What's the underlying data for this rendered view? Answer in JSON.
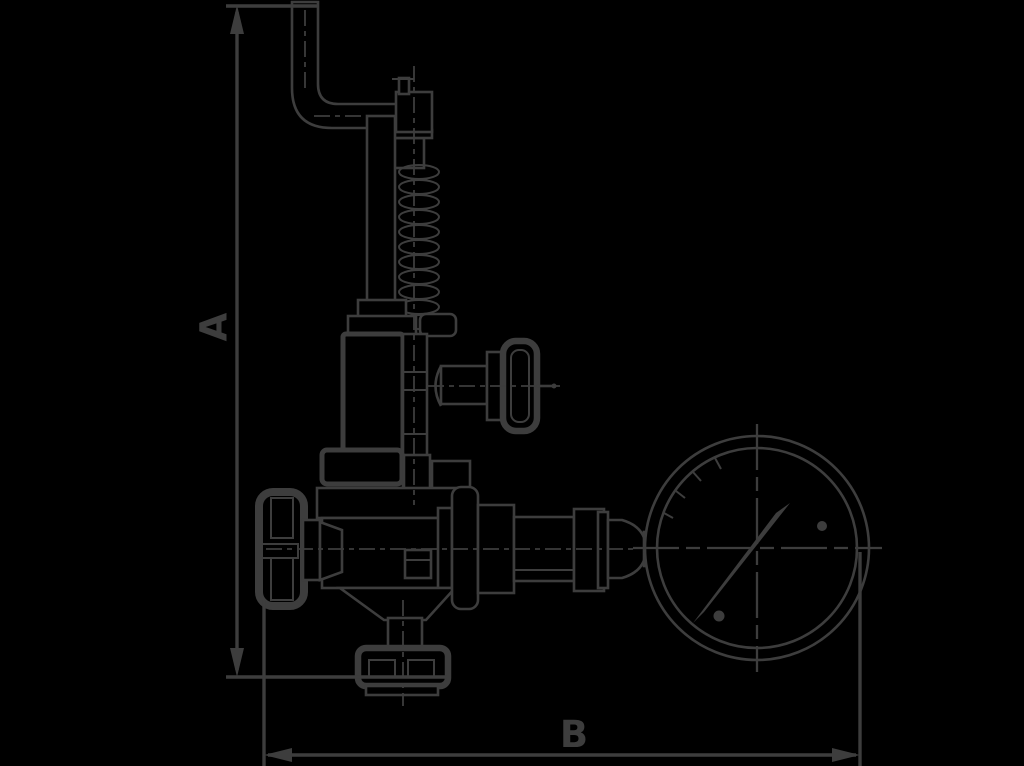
{
  "canvas": {
    "width": 1024,
    "height": 766,
    "background_color": "#000000",
    "line_color": "#3d3d3d"
  },
  "dimensions": {
    "vertical": {
      "label": "A"
    },
    "horizontal": {
      "label": "B"
    }
  },
  "diagram": {
    "type": "technical-line-drawing",
    "subject": "safety relief valve with test lever, handwheels and pressure gauge",
    "parts": [
      "test-lever-arm",
      "spindle-cap",
      "adjusting-spring",
      "spring-guide-tube",
      "spring-bonnet",
      "side-handwheel",
      "gland-flange",
      "valve-body",
      "outlet-flange",
      "inlet-handwheel",
      "gauge-piping",
      "union-nuts",
      "pressure-gauge",
      "gauge-needle"
    ]
  }
}
